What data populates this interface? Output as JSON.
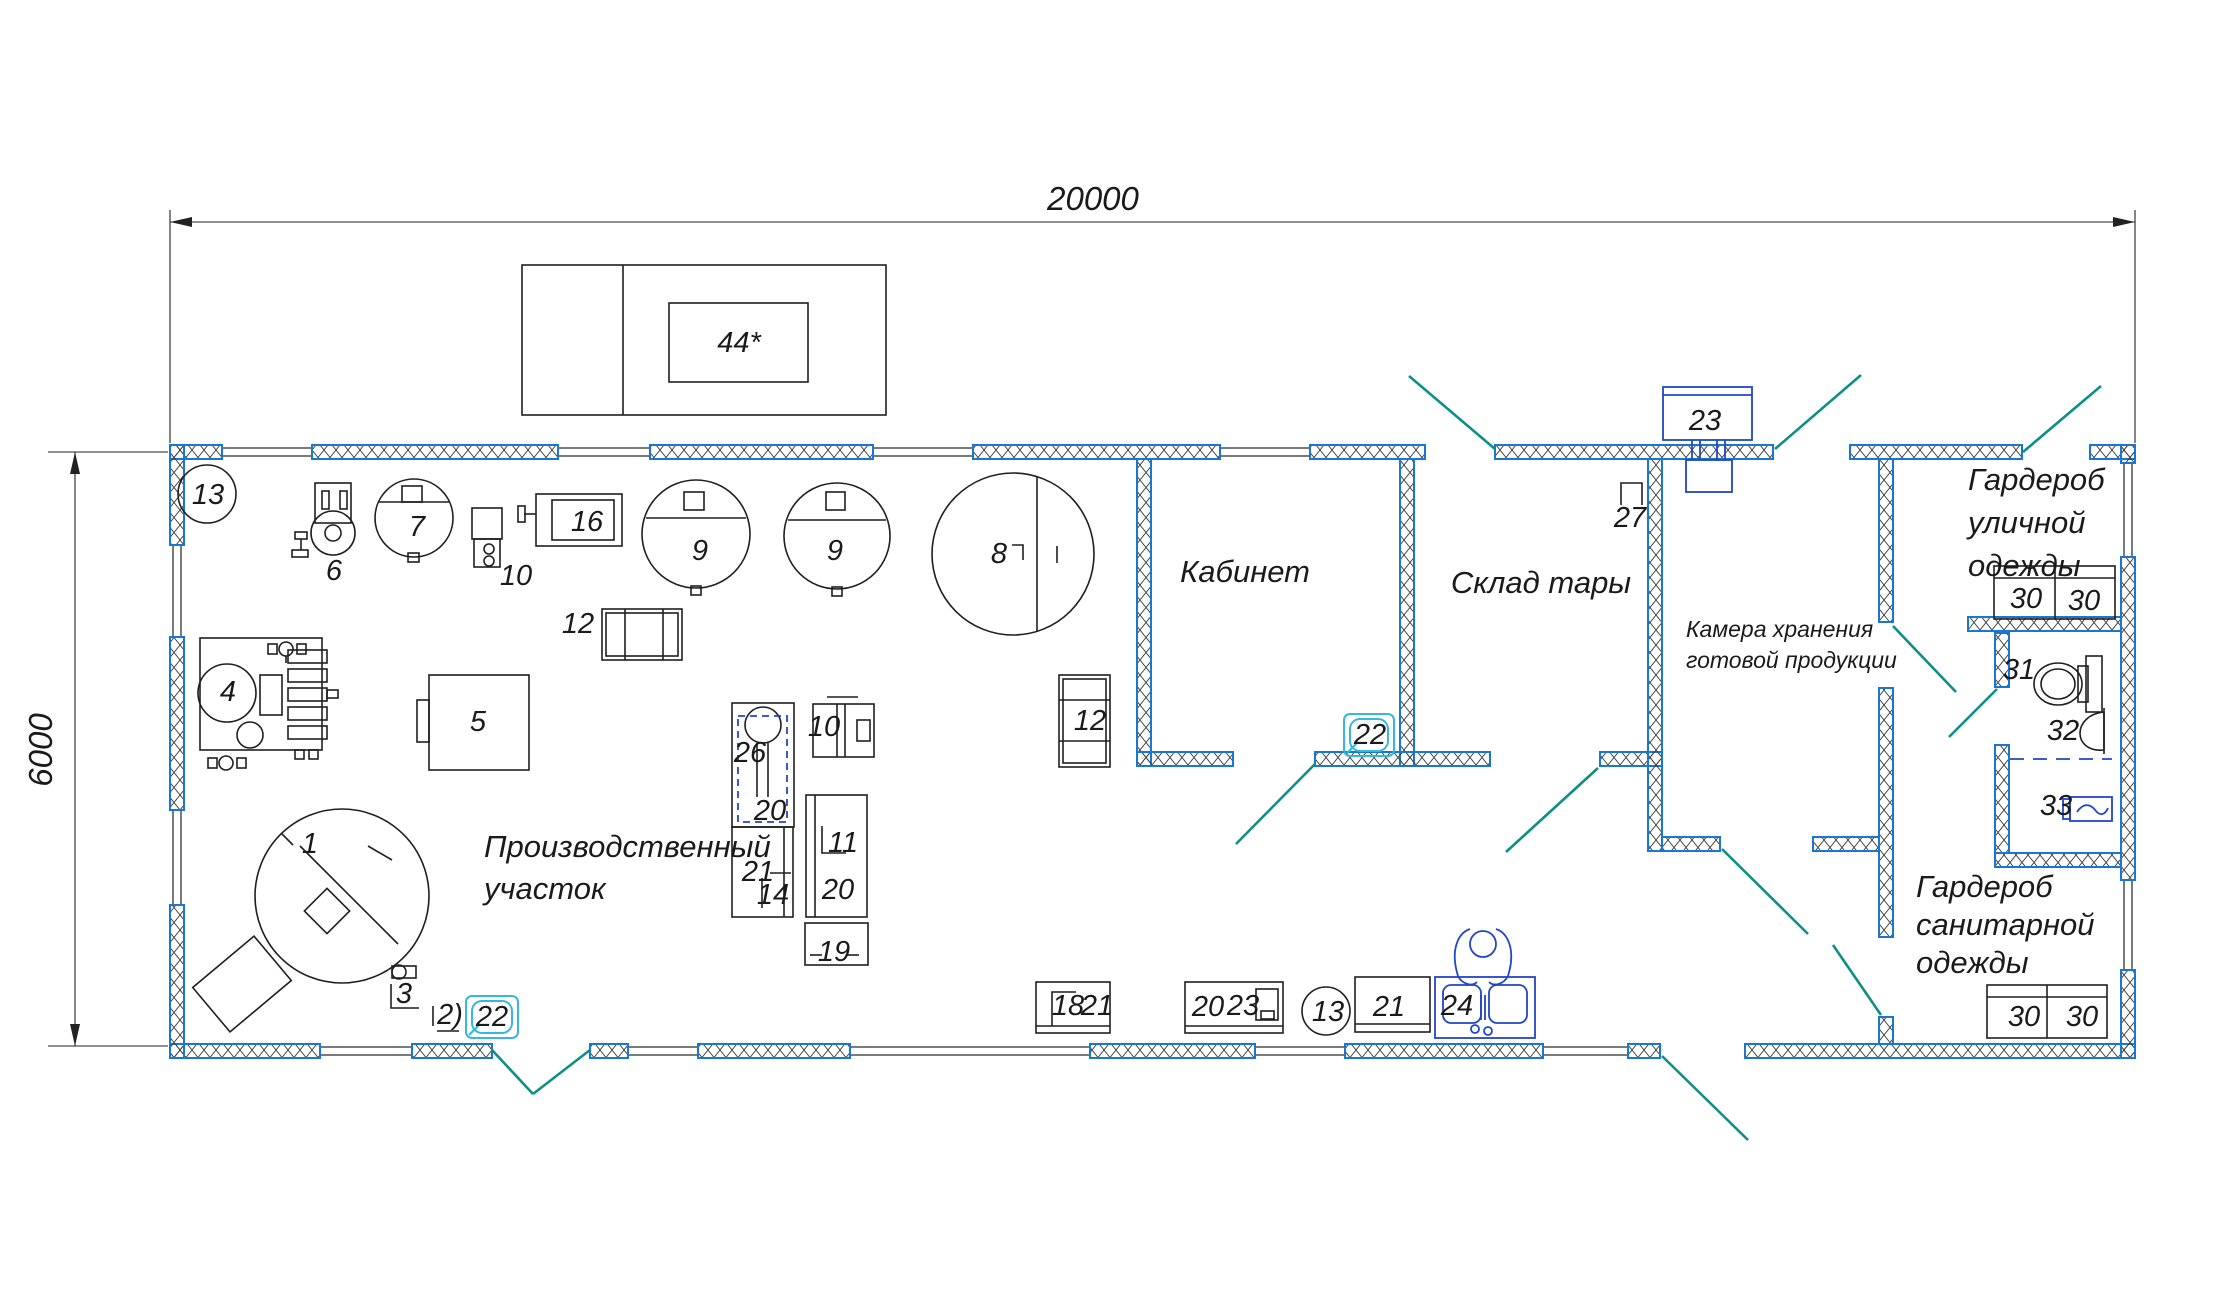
{
  "drawing": {
    "dims": {
      "width": "20000",
      "height": "6000"
    },
    "roof_unit_label": "44*",
    "rooms": {
      "production": {
        "line1": "Производственный",
        "line2": "участок"
      },
      "office": {
        "label": "Кабинет"
      },
      "warehouse": {
        "label": "Склад тары"
      },
      "chamber": {
        "line1": "Камера хранения",
        "line2": "готовой продукции"
      },
      "street_wardrobe": {
        "line1": "Гардероб",
        "line2": "уличной",
        "line3": "одежды"
      },
      "sanitary_wardrobe": {
        "line1": "Гардероб",
        "line2": "санитарной",
        "line3": "одежды"
      }
    },
    "colors": {
      "wall_outline": "#1877d2",
      "door_swing": "#0d8f86",
      "fixture_blue": "#2146c7",
      "fixture_cyan": "#35b8dc",
      "line": "#1a1a1a"
    },
    "markers": [
      {
        "label": "13",
        "x": 208,
        "y": 504
      },
      {
        "label": "6",
        "x": 334,
        "y": 580
      },
      {
        "label": "7",
        "x": 417,
        "y": 536
      },
      {
        "label": "10",
        "x": 516,
        "y": 585
      },
      {
        "label": "16",
        "x": 587,
        "y": 531
      },
      {
        "label": "12",
        "x": 578,
        "y": 633
      },
      {
        "label": "9",
        "x": 700,
        "y": 560
      },
      {
        "label": "9",
        "x": 835,
        "y": 560
      },
      {
        "label": "8",
        "x": 999,
        "y": 563
      },
      {
        "label": "12",
        "x": 1090,
        "y": 730
      },
      {
        "label": "4",
        "x": 228,
        "y": 701
      },
      {
        "label": "5",
        "x": 478,
        "y": 731
      },
      {
        "label": "26",
        "x": 750,
        "y": 762
      },
      {
        "label": "20",
        "x": 770,
        "y": 820
      },
      {
        "label": "10",
        "x": 824,
        "y": 736
      },
      {
        "label": "21",
        "x": 758,
        "y": 881
      },
      {
        "label": "14",
        "x": 773,
        "y": 904
      },
      {
        "label": "11",
        "x": 843,
        "y": 852
      },
      {
        "label": "20",
        "x": 838,
        "y": 899
      },
      {
        "label": "19",
        "x": 834,
        "y": 961
      },
      {
        "label": "1",
        "x": 310,
        "y": 853
      },
      {
        "label": "3",
        "x": 404,
        "y": 1003
      },
      {
        "label": "2)",
        "x": 450,
        "y": 1024
      },
      {
        "label": "22",
        "x": 492,
        "y": 1026
      },
      {
        "label": "22",
        "x": 1370,
        "y": 744
      },
      {
        "label": "23",
        "x": 1705,
        "y": 430
      },
      {
        "label": "27",
        "x": 1630,
        "y": 527
      },
      {
        "label": "30",
        "x": 2026,
        "y": 608
      },
      {
        "label": "30",
        "x": 2084,
        "y": 610
      },
      {
        "label": "31",
        "x": 2019,
        "y": 679
      },
      {
        "label": "32",
        "x": 2063,
        "y": 740
      },
      {
        "label": "33",
        "x": 2056,
        "y": 815
      },
      {
        "label": "30",
        "x": 2024,
        "y": 1026
      },
      {
        "label": "30",
        "x": 2082,
        "y": 1026
      },
      {
        "label": "18",
        "x": 1068,
        "y": 1015
      },
      {
        "label": "21",
        "x": 1097,
        "y": 1015
      },
      {
        "label": "20",
        "x": 1208,
        "y": 1016
      },
      {
        "label": "23",
        "x": 1243,
        "y": 1015
      },
      {
        "label": "13",
        "x": 1328,
        "y": 1021
      },
      {
        "label": "21",
        "x": 1389,
        "y": 1016
      },
      {
        "label": "24",
        "x": 1457,
        "y": 1015
      }
    ]
  }
}
